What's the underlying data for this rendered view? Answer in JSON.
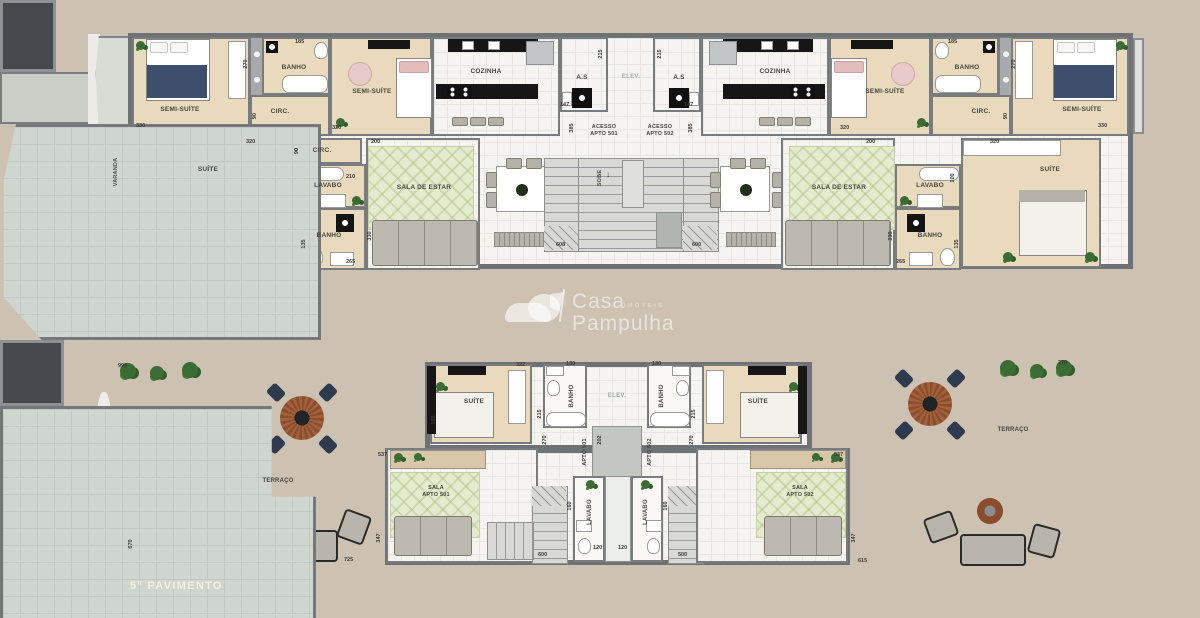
{
  "colors": {
    "background": "#cdc2b1",
    "wall": "#6f7274",
    "wood_floor": "#eadabd",
    "tile_floor": "#f5f4f1",
    "terrace_floor": "#cfd5cf",
    "rug_green": "#e5ebcf",
    "elevator": "#45484c",
    "navy_furniture": "#3d4f6d",
    "table_brown": "#a5603a",
    "plant_green": "#3a6c33",
    "floor_title_text": "#f6f0e0"
  },
  "floor4": {
    "title": "4° PAVIMENTO"
  },
  "floor5": {
    "title": "5° PAVIMENTO"
  },
  "watermark": {
    "brand_top": "Casa",
    "brand_mid": "imóveis",
    "brand_bottom": "Pampulha"
  },
  "labels": {
    "varanda": "VARANDA",
    "semi_suite": "SEMI-SUÍTE",
    "banho": "BANHO",
    "circ": "CIRC.",
    "suite": "SUÍTE",
    "lavabo": "LAVABO",
    "sala_de_estar": "SALA DE ESTAR",
    "cozinha": "COZINHA",
    "area_servico": "A.S",
    "elevador": "ELEV.",
    "acesso": "ACESSO",
    "apto_501": "APTO 501",
    "apto_502": "APTO 502",
    "sobe": "SOBE",
    "terraco": "TERRAÇO",
    "sala": "SALA"
  },
  "dims": {
    "d90": "90",
    "d100": "100",
    "d120": "120",
    "d130": "130",
    "d135": "135",
    "d147": "147",
    "d160": "160",
    "d165": "165",
    "d185": "185",
    "d200": "200",
    "d202": "202",
    "d210": "210",
    "d215": "215",
    "d265": "265",
    "d270": "270",
    "d320": "320",
    "d322": "322",
    "d330": "330",
    "d347": "347",
    "d385": "385",
    "d500": "500",
    "d537": "537",
    "d600": "600",
    "d608": "608",
    "d615": "615",
    "d670": "670",
    "d725": "725",
    "d995": "995"
  }
}
